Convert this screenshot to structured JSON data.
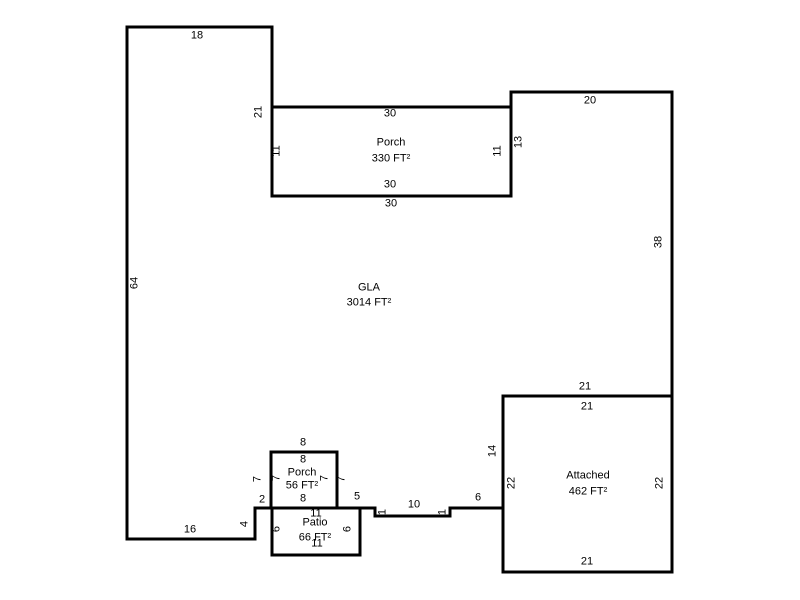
{
  "drawing": {
    "background": "#ffffff",
    "line_color": "#000000",
    "text_color": "#000000",
    "scale_px_per_ft": 8,
    "polygons": [
      {
        "name": "gla-outline",
        "points": "127,27 272,27 272,196 511,196 511,92 672,92 672,396 503,396 503,508 450,508 450,516 375,516 375,508 255,508 255,539 127,539"
      },
      {
        "name": "porch-330-outline",
        "points": "272,107 511,107 511,196 272,196"
      },
      {
        "name": "porch-56-outline",
        "points": "271,452 337,452 337,508 271,508"
      },
      {
        "name": "patio-66-outline",
        "points": "272,508 360,508 360,555 272,555"
      },
      {
        "name": "attached-462-outline",
        "points": "503,396 672,396 672,572 503,572"
      }
    ],
    "area_labels": [
      {
        "name": "gla",
        "label": "GLA",
        "area": "3014 FT²",
        "x": 369,
        "label_y": 288,
        "area_y": 303
      },
      {
        "name": "porch-330",
        "label": "Porch",
        "area": "330 FT²",
        "x": 391,
        "label_y": 143,
        "area_y": 159
      },
      {
        "name": "porch-56",
        "label": "Porch",
        "area": "56 FT²",
        "x": 302,
        "label_y": 473,
        "area_y": 486
      },
      {
        "name": "patio-66",
        "label": "Patio",
        "area": "66 FT²",
        "x": 315,
        "label_y": 523,
        "area_y": 538
      },
      {
        "name": "attached-462",
        "label": "Attached",
        "area": "462 FT²",
        "x": 588,
        "label_y": 476,
        "area_y": 492
      }
    ],
    "dim_labels": [
      {
        "text": "18",
        "x": 197,
        "y": 36,
        "rot": 0
      },
      {
        "text": "21",
        "x": 259,
        "y": 112,
        "rot": -90
      },
      {
        "text": "30",
        "x": 390,
        "y": 114,
        "rot": 0
      },
      {
        "text": "11",
        "x": 277,
        "y": 151,
        "rot": -90
      },
      {
        "text": "11",
        "x": 498,
        "y": 151,
        "rot": -90
      },
      {
        "text": "13",
        "x": 519,
        "y": 142,
        "rot": -90
      },
      {
        "text": "30",
        "x": 390,
        "y": 185,
        "rot": 0
      },
      {
        "text": "30",
        "x": 391,
        "y": 204,
        "rot": 0
      },
      {
        "text": "20",
        "x": 590,
        "y": 101,
        "rot": 0
      },
      {
        "text": "38",
        "x": 659,
        "y": 242,
        "rot": -90
      },
      {
        "text": "64",
        "x": 135,
        "y": 283,
        "rot": -90
      },
      {
        "text": "21",
        "x": 585,
        "y": 387,
        "rot": 0
      },
      {
        "text": "21",
        "x": 587,
        "y": 407,
        "rot": 0
      },
      {
        "text": "14",
        "x": 493,
        "y": 451,
        "rot": -90
      },
      {
        "text": "22",
        "x": 512,
        "y": 483,
        "rot": -90
      },
      {
        "text": "22",
        "x": 660,
        "y": 483,
        "rot": -90
      },
      {
        "text": "21",
        "x": 587,
        "y": 562,
        "rot": 0
      },
      {
        "text": "8",
        "x": 303,
        "y": 443,
        "rot": 0
      },
      {
        "text": "8",
        "x": 303,
        "y": 460,
        "rot": 0
      },
      {
        "text": "8",
        "x": 303,
        "y": 499,
        "rot": 0
      },
      {
        "text": "7",
        "x": 258,
        "y": 479,
        "rot": -90
      },
      {
        "text": "7",
        "x": 277,
        "y": 478,
        "rot": -90
      },
      {
        "text": "7",
        "x": 325,
        "y": 478,
        "rot": -90
      },
      {
        "text": "7",
        "x": 342,
        "y": 479,
        "rot": -90
      },
      {
        "text": "2",
        "x": 262,
        "y": 500,
        "rot": 0
      },
      {
        "text": "5",
        "x": 357,
        "y": 497,
        "rot": 0
      },
      {
        "text": "1",
        "x": 383,
        "y": 512,
        "rot": -90
      },
      {
        "text": "10",
        "x": 414,
        "y": 505,
        "rot": 0
      },
      {
        "text": "1",
        "x": 443,
        "y": 512,
        "rot": -90
      },
      {
        "text": "6",
        "x": 478,
        "y": 498,
        "rot": 0
      },
      {
        "text": "4",
        "x": 245,
        "y": 524,
        "rot": -90
      },
      {
        "text": "16",
        "x": 190,
        "y": 530,
        "rot": 0
      },
      {
        "text": "11",
        "x": 316,
        "y": 514,
        "rot": 0
      },
      {
        "text": "11",
        "x": 317,
        "y": 544,
        "rot": 0
      },
      {
        "text": "6",
        "x": 277,
        "y": 529,
        "rot": -90
      },
      {
        "text": "6",
        "x": 348,
        "y": 529,
        "rot": -90
      }
    ]
  }
}
